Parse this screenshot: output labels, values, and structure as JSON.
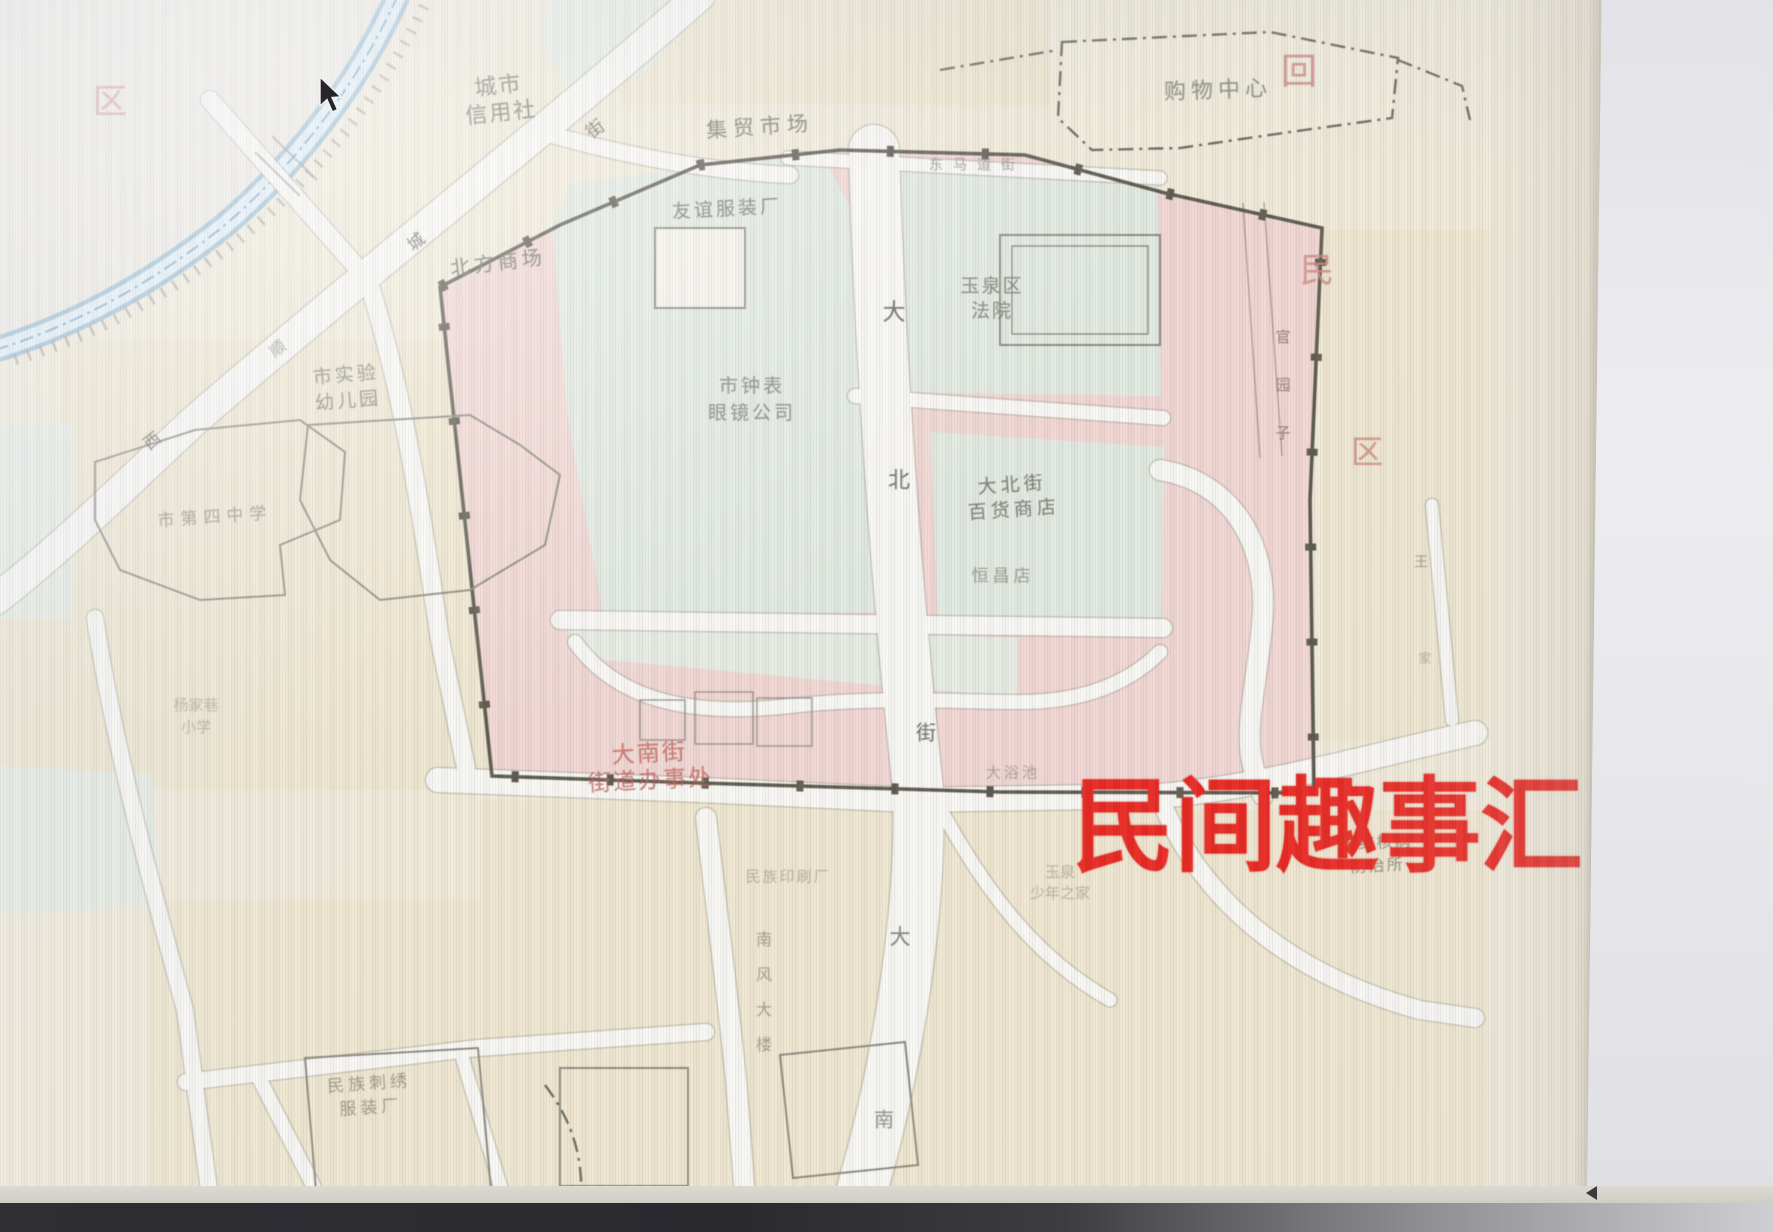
{
  "palette": {
    "paper": "#f0ead8",
    "pink": "#f0d6d2",
    "green": "#e1e9e0",
    "green2": "#e6ece2",
    "yellow": "#ece2c4",
    "road": "#f8f7f3",
    "water_edge": "#8fb6cc",
    "water_fill": "#ddeef7",
    "boundary": "#5b574c",
    "watermark": "#e8241d"
  },
  "watermark": {
    "text": "民间趣事汇"
  },
  "labels": [
    {
      "name": "label-city-credit-union",
      "lines": [
        "城市",
        "信用社"
      ],
      "x": 500,
      "y": 100,
      "size": 22,
      "lh": 27,
      "color": "#6e6e62",
      "rot": -6,
      "ls": 2,
      "op": 0.9
    },
    {
      "name": "street-char-jie-1",
      "lines": [
        "街"
      ],
      "x": 596,
      "y": 130,
      "size": 18,
      "color": "#5d5b50",
      "rot": -38,
      "op": 0.85
    },
    {
      "name": "label-market",
      "lines": [
        "集贸市场"
      ],
      "x": 760,
      "y": 127,
      "size": 21,
      "color": "#6e6e62",
      "rot": -4,
      "ls": 6,
      "op": 0.85
    },
    {
      "name": "label-shopping-center",
      "lines": [
        "购物中心"
      ],
      "x": 1218,
      "y": 91,
      "size": 22,
      "color": "#7a796d",
      "rot": -2,
      "ls": 5,
      "op": 0.8
    },
    {
      "name": "label-friendship-garment-factory",
      "lines": [
        "友谊服装厂"
      ],
      "x": 727,
      "y": 210,
      "size": 19,
      "color": "#70706a",
      "rot": -3,
      "ls": 3,
      "op": 0.85
    },
    {
      "name": "label-north-mall",
      "lines": [
        "北方商场"
      ],
      "x": 498,
      "y": 263,
      "size": 20,
      "color": "#6e6e62",
      "rot": -7,
      "ls": 4,
      "op": 0.9
    },
    {
      "name": "street-char-cheng",
      "lines": [
        "城"
      ],
      "x": 417,
      "y": 243,
      "size": 17,
      "color": "#5d5b50",
      "rot": -38,
      "op": 0.85
    },
    {
      "name": "street-char-shun",
      "lines": [
        "顺"
      ],
      "x": 278,
      "y": 349,
      "size": 16,
      "color": "#5d5b50",
      "rot": -38,
      "op": 0.6
    },
    {
      "name": "street-char-xi",
      "lines": [
        "西"
      ],
      "x": 153,
      "y": 442,
      "size": 17,
      "color": "#5d5b50",
      "rot": -38,
      "op": 0.8
    },
    {
      "name": "label-dongmadao-street",
      "lines": [
        "东马道街"
      ],
      "x": 977,
      "y": 166,
      "size": 14,
      "color": "#8a887c",
      "ls": 10,
      "op": 0.7
    },
    {
      "name": "label-yuquan-district-court",
      "lines": [
        "玉泉区",
        "法院"
      ],
      "x": 992,
      "y": 299,
      "size": 19,
      "lh": 25,
      "color": "#73736a",
      "ls": 2,
      "op": 0.8
    },
    {
      "name": "street-char-da-1",
      "lines": [
        "大"
      ],
      "x": 894,
      "y": 313,
      "size": 23,
      "color": "#55534a",
      "op": 0.85
    },
    {
      "name": "street-char-bei",
      "lines": [
        "北"
      ],
      "x": 899,
      "y": 481,
      "size": 22,
      "color": "#55534a",
      "op": 0.8
    },
    {
      "name": "street-char-jie-2",
      "lines": [
        "街"
      ],
      "x": 926,
      "y": 733,
      "size": 20,
      "color": "#55534a",
      "op": 0.8
    },
    {
      "name": "label-clock-glasses-company",
      "lines": [
        "市钟表",
        "眼镜公司"
      ],
      "x": 752,
      "y": 400,
      "size": 19,
      "lh": 27,
      "color": "#73736a",
      "ls": 3,
      "op": 0.8
    },
    {
      "name": "label-experimental-kindergarten",
      "lines": [
        "市实验",
        "幼儿园"
      ],
      "x": 347,
      "y": 388,
      "size": 19,
      "lh": 26,
      "color": "#73736a",
      "rot": -5,
      "ls": 3,
      "op": 0.8
    },
    {
      "name": "label-no4-middle-school",
      "lines": [
        "市第四中学"
      ],
      "x": 215,
      "y": 518,
      "size": 17,
      "color": "#7c7a70",
      "rot": -4,
      "ls": 6,
      "op": 0.7
    },
    {
      "name": "label-dabeijie-department-store",
      "lines": [
        "大北街",
        "百货商店"
      ],
      "x": 1013,
      "y": 498,
      "size": 19,
      "lh": 25,
      "color": "#6f6f66",
      "rot": -4,
      "ls": 4,
      "op": 0.85
    },
    {
      "name": "label-hengchang-store",
      "lines": [
        "恒昌店"
      ],
      "x": 1003,
      "y": 577,
      "size": 17,
      "color": "#7c7a70",
      "ls": 4,
      "op": 0.65
    },
    {
      "name": "label-guanyuanzi-lane",
      "lines": [
        "官",
        "园",
        "子"
      ],
      "x": 1283,
      "y": 385,
      "size": 15,
      "lh": 48,
      "color": "#8a6f6b",
      "op": 0.8
    },
    {
      "name": "street-char-wang",
      "lines": [
        "王"
      ],
      "x": 1421,
      "y": 563,
      "size": 14,
      "color": "#8a887c",
      "op": 0.75
    },
    {
      "name": "street-char-jia",
      "lines": [
        "家"
      ],
      "x": 1425,
      "y": 660,
      "size": 13,
      "color": "#8a887c",
      "op": 0.5
    },
    {
      "name": "label-yangjiaxiang-primary",
      "lines": [
        "杨家巷",
        "小学"
      ],
      "x": 196,
      "y": 716,
      "size": 15,
      "lh": 22,
      "color": "#8a887c",
      "op": 0.5
    },
    {
      "name": "label-dananjie-subdistrict-office",
      "lines": [
        "大南街",
        "街道办事处"
      ],
      "x": 650,
      "y": 768,
      "size": 23,
      "lh": 27,
      "color": "#c45a4f",
      "rot": -3,
      "ls": 2,
      "op": 0.75
    },
    {
      "name": "label-bathhouse",
      "lines": [
        "大浴池"
      ],
      "x": 1013,
      "y": 773,
      "size": 15,
      "color": "#8a887c",
      "ls": 3,
      "op": 0.6
    },
    {
      "name": "label-tb-prevention-center",
      "lines": [
        "市结核病",
        "防治所"
      ],
      "x": 1377,
      "y": 854,
      "size": 16,
      "lh": 23,
      "color": "#7c7a70",
      "rot": -3,
      "ls": 2,
      "op": 0.75
    },
    {
      "name": "label-youth-home",
      "lines": [
        "玉泉",
        "少年之家"
      ],
      "x": 1060,
      "y": 883,
      "size": 15,
      "lh": 21,
      "color": "#8a887c",
      "op": 0.5
    },
    {
      "name": "label-printing-factory",
      "lines": [
        "民族印刷厂"
      ],
      "x": 788,
      "y": 877,
      "size": 15,
      "color": "#8a887c",
      "ls": 2,
      "op": 0.5
    },
    {
      "name": "label-ethnic-garment-factory",
      "lines": [
        "民族刺绣",
        "服装厂"
      ],
      "x": 370,
      "y": 1096,
      "size": 17,
      "lh": 24,
      "color": "#7c7a70",
      "rot": -4,
      "ls": 4,
      "op": 0.65
    },
    {
      "name": "label-nanfeng-building",
      "lines": [
        "南",
        "风",
        "大",
        "楼"
      ],
      "x": 764,
      "y": 992,
      "size": 16,
      "lh": 35,
      "color": "#6f6d62",
      "op": 0.55
    },
    {
      "name": "street-char-da-2",
      "lines": [
        "大"
      ],
      "x": 900,
      "y": 937,
      "size": 21,
      "color": "#55534a",
      "op": 0.7
    },
    {
      "name": "street-char-nan",
      "lines": [
        "南"
      ],
      "x": 884,
      "y": 1120,
      "size": 20,
      "color": "#55534a",
      "op": 0.6
    },
    {
      "name": "district-char-qu-left",
      "lines": [
        "区"
      ],
      "x": 110,
      "y": 102,
      "size": 34,
      "color": "#cf8880",
      "op": 0.85
    },
    {
      "name": "district-char-hui",
      "lines": [
        "回"
      ],
      "x": 1299,
      "y": 72,
      "size": 36,
      "color": "#cf8880",
      "op": 0.85
    },
    {
      "name": "district-char-min",
      "lines": [
        "民"
      ],
      "x": 1317,
      "y": 271,
      "size": 34,
      "color": "#cf8880",
      "op": 0.8
    },
    {
      "name": "district-char-qu-right",
      "lines": [
        "区"
      ],
      "x": 1367,
      "y": 452,
      "size": 32,
      "color": "#cf8880",
      "op": 0.8
    }
  ]
}
